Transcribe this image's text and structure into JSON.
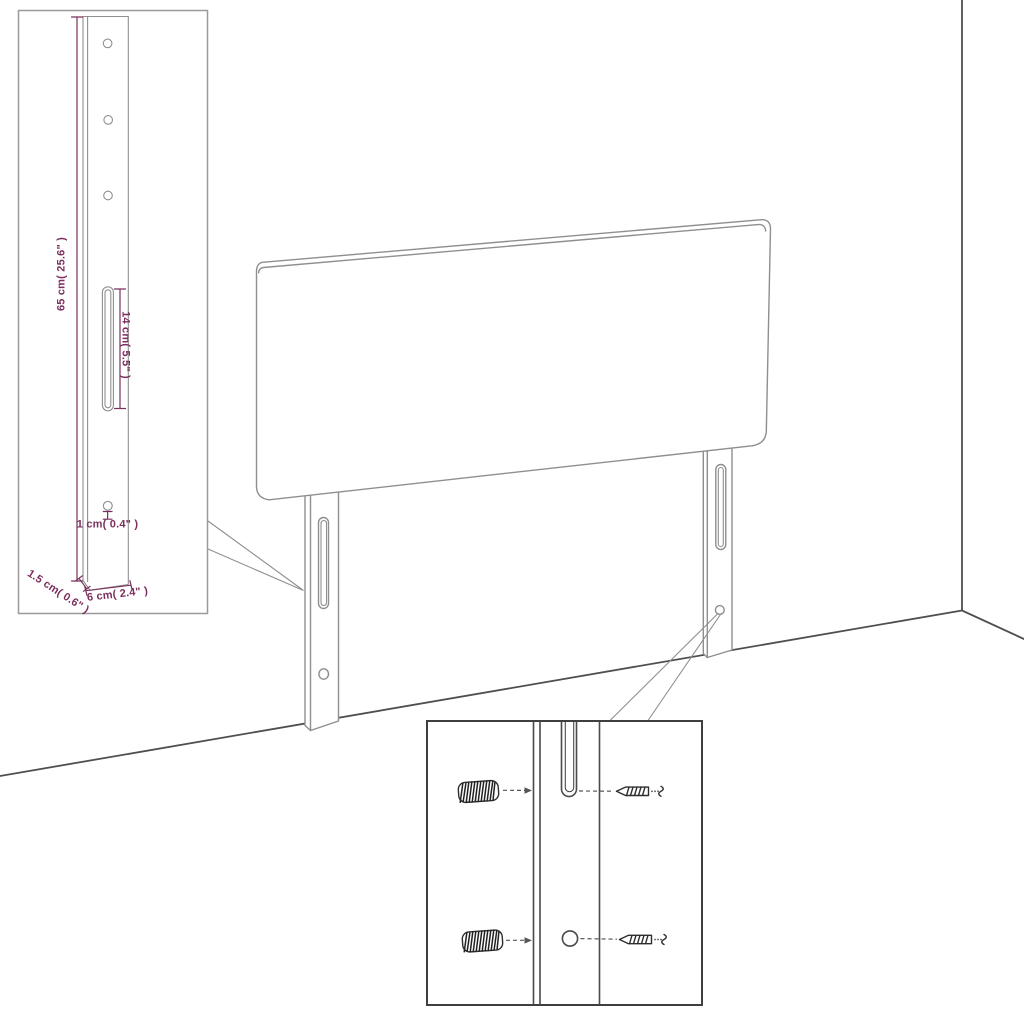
{
  "diagram": {
    "leg_detail": {
      "dim_height": "65 cm( 25.6\" )",
      "dim_slot": "14 cm( 5.5\" )",
      "dim_hole": "1 cm( 0.4\" )",
      "dim_thickness": "1.5 cm( 0.6\" )",
      "dim_width": "6 cm( 2.4\" )"
    },
    "colors": {
      "dimension_accent": "#7b2f5e",
      "line_art": "#8f8f8f",
      "dark_line": "#4f4f4f",
      "background": "#ffffff"
    }
  }
}
